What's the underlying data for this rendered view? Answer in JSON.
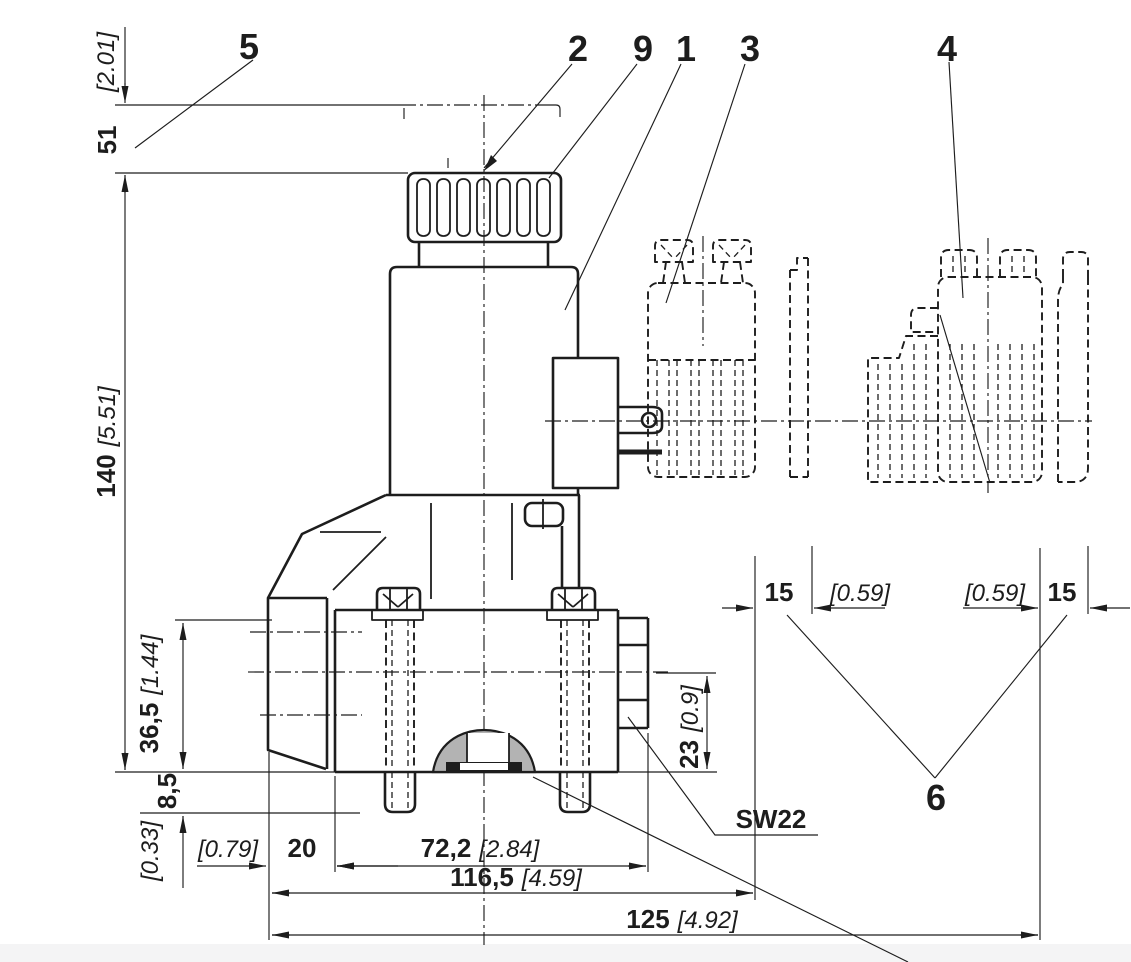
{
  "drawing": {
    "type": "technical-dimension-drawing",
    "subject": "solenoid valve with hand knob and connector variants",
    "colors": {
      "line": "#1d1d1d",
      "seal_gray": "#b3b3b3",
      "background": "#ffffff",
      "bottom_margin": "#f4f4f5"
    },
    "callouts": {
      "item_1": "1",
      "item_2": "2",
      "item_3": "3",
      "item_4": "4",
      "item_5": "5",
      "item_6": "6",
      "item_9": "9"
    },
    "dims": {
      "d51_mm": "51",
      "d51_in": "[2.01]",
      "d140_mm": "140",
      "d140_in": "[5.51]",
      "d36_mm": "36,5",
      "d36_in": "[1.44]",
      "d85_mm": "8,5",
      "d85_in": "[0.33]",
      "d20_mm": "20",
      "d20_in": "[0.79]",
      "d72_mm": "72,2",
      "d72_in": "[2.84]",
      "d116_mm": "116,5",
      "d116_in": "[4.59]",
      "d125_mm": "125",
      "d125_in": "[4.92]",
      "d15_left_mm": "15",
      "d15_left_in": "[0.59]",
      "d15_right_in": "[0.59]",
      "d15_right_mm": "15",
      "d23_mm": "23",
      "d23_in": "[0.9]",
      "wrench_size": "SW22"
    }
  }
}
